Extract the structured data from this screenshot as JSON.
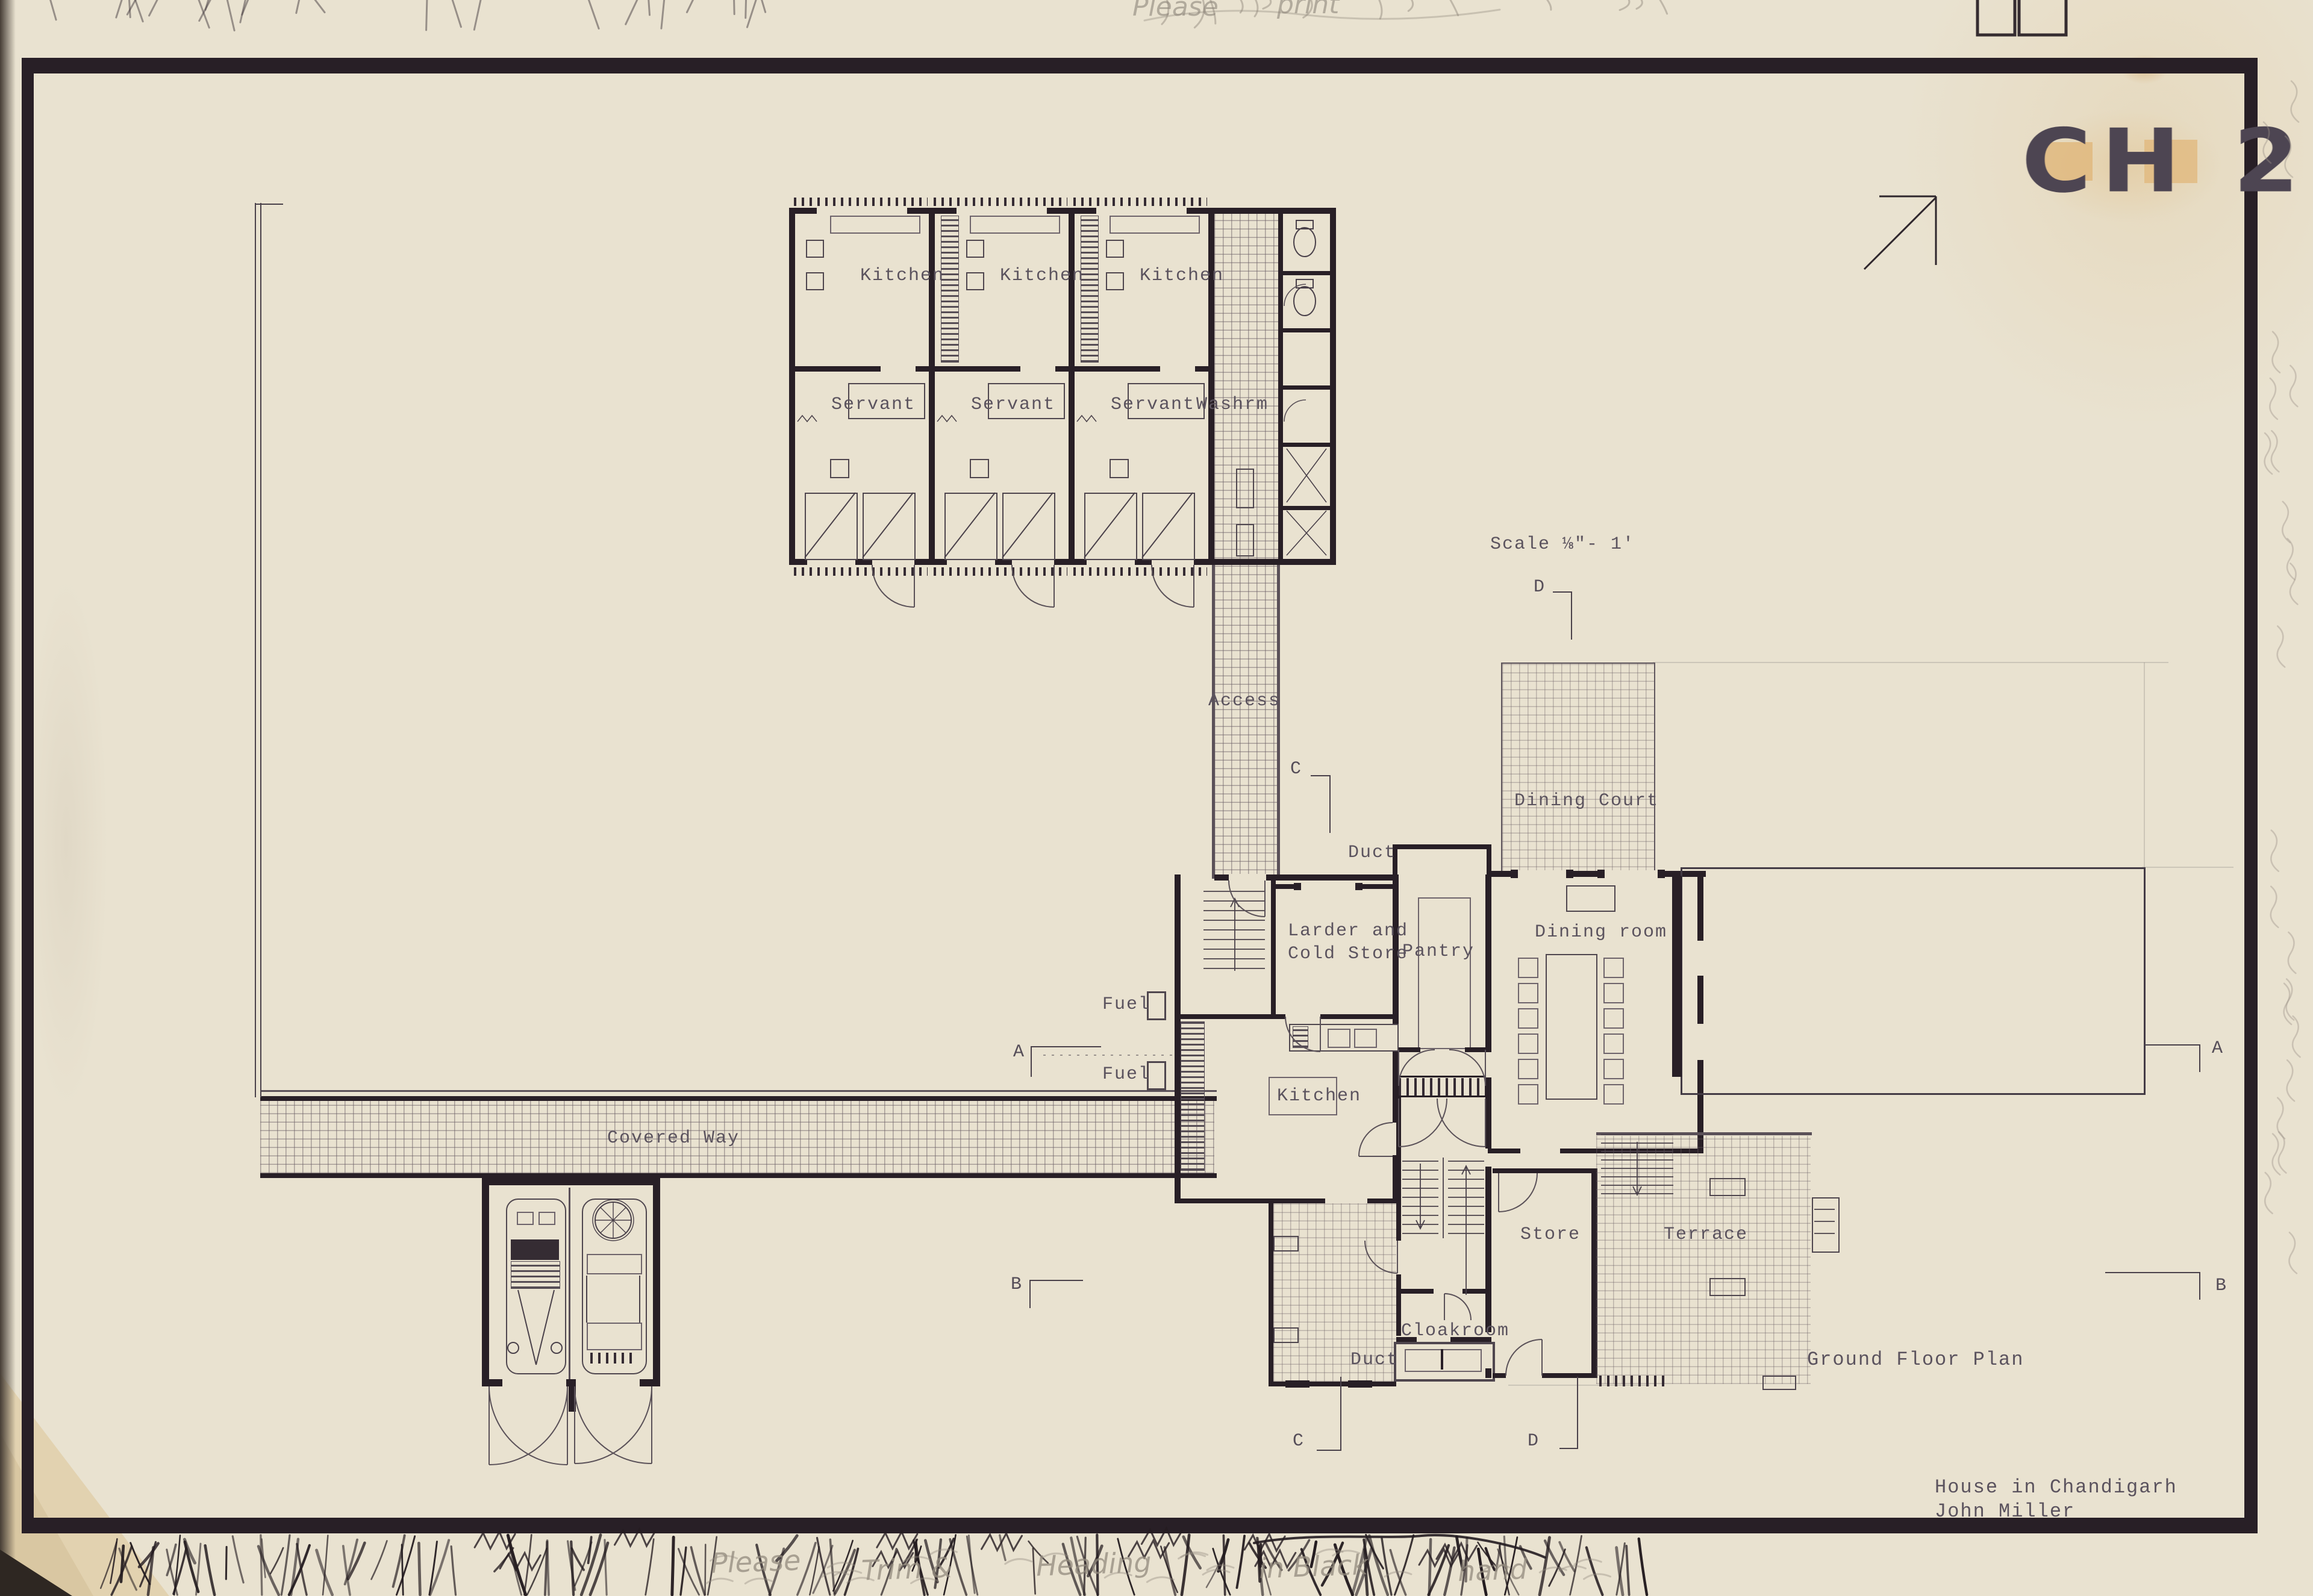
{
  "sheet": {
    "code": "CH 2",
    "scale_note": "Scale ⅛\"- 1'",
    "plan_title": "Ground Floor Plan",
    "project": "House in Chandigarh",
    "architect": "John Miller"
  },
  "servant_quarters": {
    "units": [
      {
        "kitchen": "Kitchen",
        "room": "Servant"
      },
      {
        "kitchen": "Kitchen",
        "room": "Servant"
      },
      {
        "kitchen": "Kitchen",
        "room": "Servant"
      }
    ],
    "washroom": "Washrm"
  },
  "rooms": {
    "access": "Access",
    "duct_upper": "Duct",
    "larder_line1": "Larder and",
    "larder_line2": "Cold Store",
    "pantry": "Pantry",
    "dining_room": "Dining room",
    "dining_court": "Dining Court",
    "kitchen": "Kitchen",
    "fuel_upper": "Fuel",
    "fuel_lower": "Fuel",
    "covered_way": "Covered Way",
    "store": "Store",
    "terrace": "Terrace",
    "cloakroom": "Cloakroom",
    "duct_lower": "Duct"
  },
  "section_markers": {
    "a_left": "A",
    "a_right": "A",
    "b_left": "B",
    "b_right": "B",
    "c_top": "C",
    "c_bottom": "C",
    "d_top": "D",
    "d_bottom": "D"
  },
  "annotations": {
    "top_fragments": [
      "Please",
      "print"
    ],
    "bottom_fragments": [
      "Please",
      "Trim &",
      "Heading",
      "in Black",
      "hand"
    ]
  }
}
